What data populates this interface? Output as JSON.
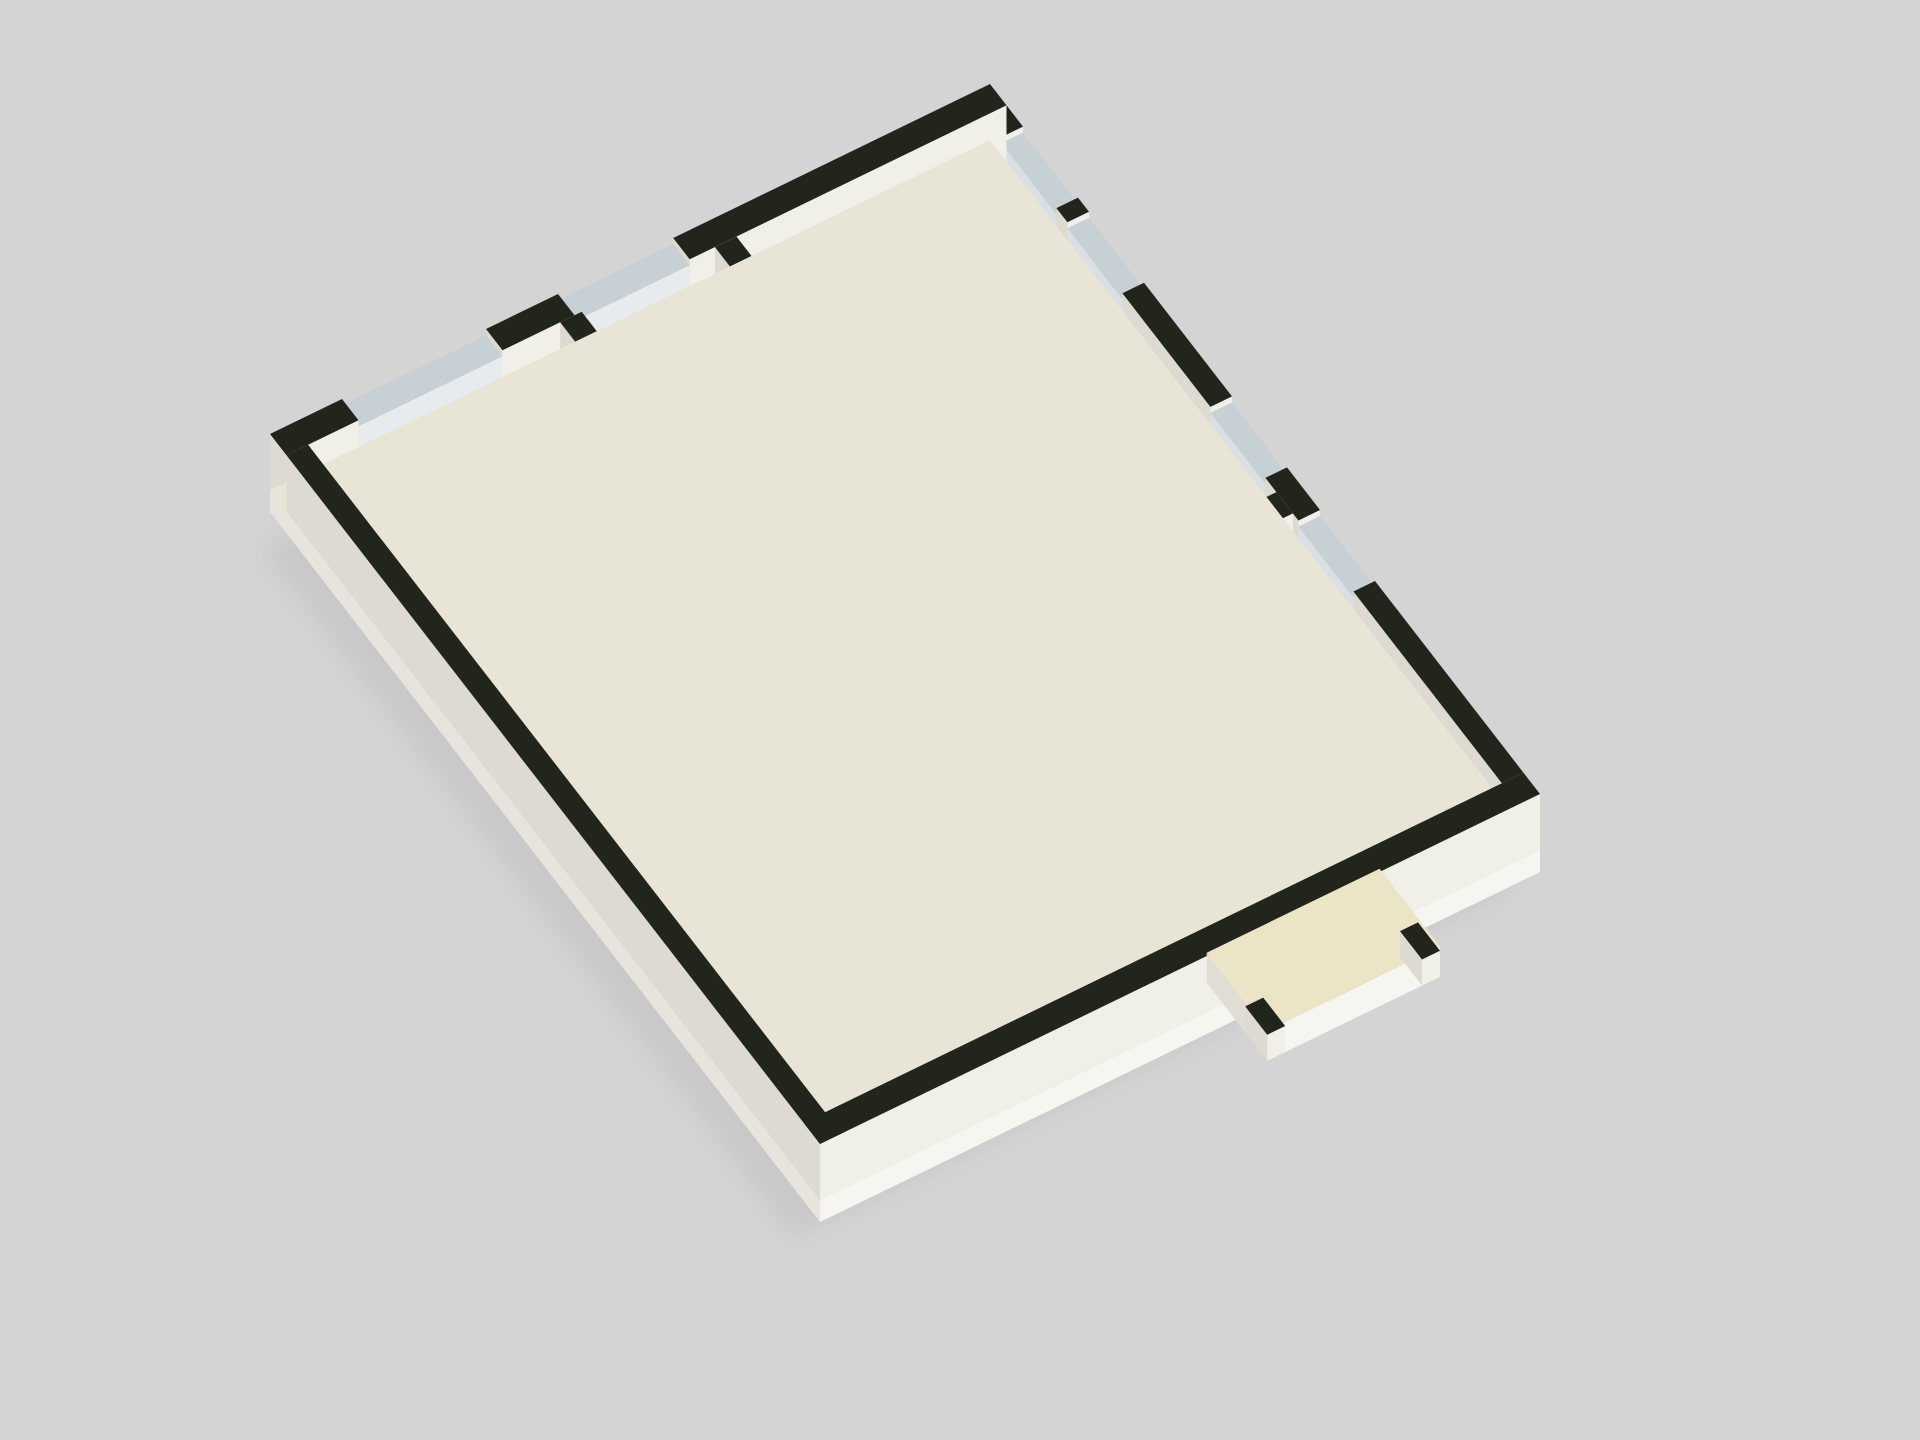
{
  "scene_type": "isometric-3d-floor-plan-render",
  "background": "#d4d4d4",
  "iso": {
    "ox": 270,
    "oy": 490,
    "ax": 7.2,
    "ay": -3.5,
    "bx": 5.5,
    "by": 7.1
  },
  "palette": {
    "colors": {
      "floorBase": "#e9e5d6",
      "floorCream": "#f2ebc3",
      "floorTeal": "#79a39d",
      "grid": "rgba(255,255,255,0.5)",
      "tealGrid": "rgba(255,255,255,0.25)",
      "shadow": "#bfbfbf",
      "artGreen": "#3f8b33"
    },
    "sets": {
      "wall": {
        "t": "#22251b",
        "s": "#f1f0e8",
        "w": "#dddbd1"
      },
      "window": {
        "t": "#c7d0d4",
        "s": "#e7ebed",
        "w": "#d9dfe2"
      },
      "wood": {
        "t": "#e3ab5d",
        "s": "#c38c44",
        "w": "#a37132"
      },
      "door": {
        "t": "#b9873f",
        "s": "#a9762f",
        "w": "#8d5f22"
      },
      "step": {
        "t": "#f0e9cd",
        "s": "#e0d9ba",
        "w": "#cfc8a8"
      },
      "bed": {
        "t": "#f0efe9",
        "s": "#dddcd4",
        "w": "#cbcac2"
      },
      "pillow": {
        "t": "#fbfbf8",
        "s": "#e8e8e2",
        "w": "#dcdcd6"
      },
      "sofa": {
        "t": "#f3f1ea",
        "s": "#e0ded6",
        "w": "#cfcdc5"
      },
      "shelf": {
        "t": "#e0a153",
        "s": "#c98f43",
        "w": "#a5702b"
      },
      "stall": {
        "t": "#e4e7e0",
        "s": "#d5d8cf",
        "w": "#c5c8bf"
      },
      "counter": {
        "t": "#22251b",
        "s": "#f1f0e8",
        "w": "#dddbd1"
      },
      "canopy": {
        "t": "#ebe4c6",
        "s": "#f6f5ef",
        "w": "#e0ded4"
      },
      "pot": {
        "t": "#9a6c3a",
        "s": "#7d5429",
        "w": "#68451f"
      }
    }
  },
  "items": [
    {
      "t": "shadow",
      "n": "drop-shadow",
      "r": [
        0,
        0,
        100,
        100
      ],
      "layer": 0
    },
    {
      "t": "plinth",
      "n": "foundation-plinth",
      "r": [
        0,
        0,
        100,
        100
      ],
      "d": 22,
      "layer": 0
    },
    {
      "t": "flat",
      "n": "slab",
      "r": [
        0,
        0,
        100,
        100
      ],
      "f": "floorBase",
      "layer": 0
    },
    {
      "t": "flat",
      "n": "floor-marble",
      "r": [
        3,
        3,
        97,
        97
      ],
      "f": "floorCream",
      "grid": 10,
      "gc": "grid",
      "layer": 0
    },
    {
      "t": "flat",
      "n": "floor-washroom",
      "r": [
        3,
        72.5,
        50,
        97
      ],
      "f": "floorTeal",
      "grid": 10,
      "gc": "tealGrid",
      "layer": 0
    },
    {
      "t": "flat",
      "n": "floor-washroom-2",
      "r": [
        50,
        82,
        61,
        97
      ],
      "f": "floorTeal",
      "grid": 10,
      "gc": "tealGrid",
      "layer": 0
    },
    {
      "t": "box",
      "n": "wall-nw-a",
      "r": [
        0,
        0,
        10,
        3
      ],
      "h": 56,
      "c": "wall"
    },
    {
      "t": "box",
      "n": "window-nw-1",
      "r": [
        10,
        0,
        30,
        3
      ],
      "h": 50,
      "c": "window"
    },
    {
      "t": "box",
      "n": "wall-nw-b",
      "r": [
        30,
        0,
        40,
        3
      ],
      "h": 56,
      "c": "wall"
    },
    {
      "t": "box",
      "n": "window-nw-2",
      "r": [
        40,
        0,
        56,
        3
      ],
      "h": 50,
      "c": "window"
    },
    {
      "t": "box",
      "n": "wall-nw-c",
      "r": [
        56,
        0,
        100,
        3
      ],
      "h": 56,
      "c": "wall"
    },
    {
      "t": "box",
      "n": "wall-ne-a",
      "r": [
        97,
        3,
        100,
        6
      ],
      "h": 56,
      "c": "wall"
    },
    {
      "t": "box",
      "n": "window-ne-1",
      "r": [
        97,
        6,
        100,
        16
      ],
      "h": 50,
      "c": "window"
    },
    {
      "t": "box",
      "n": "wall-ne-b",
      "r": [
        97,
        16,
        100,
        18
      ],
      "h": 56,
      "c": "wall"
    },
    {
      "t": "box",
      "n": "window-ne-2",
      "r": [
        97,
        18,
        100,
        28
      ],
      "h": 50,
      "c": "window"
    },
    {
      "t": "box",
      "n": "wall-ne-c",
      "r": [
        97,
        28,
        100,
        44
      ],
      "h": 56,
      "c": "wall"
    },
    {
      "t": "box",
      "n": "window-ne-3",
      "r": [
        97,
        44,
        100,
        54
      ],
      "h": 50,
      "c": "window"
    },
    {
      "t": "box",
      "n": "wall-ne-d",
      "r": [
        97,
        54,
        100,
        60
      ],
      "h": 56,
      "c": "wall"
    },
    {
      "t": "box",
      "n": "window-ne-4",
      "r": [
        97,
        60,
        100,
        70
      ],
      "h": 50,
      "c": "window"
    },
    {
      "t": "box",
      "n": "wall-ne-e",
      "r": [
        97,
        70,
        100,
        97
      ],
      "h": 56,
      "c": "wall"
    },
    {
      "t": "box",
      "n": "wall-sw",
      "r": [
        0,
        3,
        3,
        100
      ],
      "h": 56,
      "c": "wall"
    },
    {
      "t": "box",
      "n": "wall-se",
      "r": [
        0,
        97,
        100,
        100
      ],
      "h": 56,
      "c": "wall"
    },
    {
      "t": "box",
      "n": "wall-left-room-a",
      "r": [
        3,
        40,
        22,
        43
      ],
      "h": 56,
      "c": "wall"
    },
    {
      "t": "box",
      "n": "wall-left-room-b",
      "r": [
        30,
        40,
        38,
        43
      ],
      "h": 56,
      "c": "wall"
    },
    {
      "t": "box",
      "n": "wall-bl-a",
      "r": [
        3,
        59.5,
        32,
        62.5
      ],
      "h": 56,
      "c": "wall"
    },
    {
      "t": "box",
      "n": "wall-bl-b",
      "r": [
        38,
        59.5,
        44,
        62.5
      ],
      "h": 56,
      "c": "wall"
    },
    {
      "t": "box",
      "n": "wall-mid-vert-a",
      "r": [
        38,
        3,
        41,
        14
      ],
      "h": 56,
      "c": "wall"
    },
    {
      "t": "box",
      "n": "wall-mid-vert-b",
      "r": [
        38,
        20,
        41,
        40
      ],
      "h": 56,
      "c": "wall"
    },
    {
      "t": "box",
      "n": "wall-mid-vert-c",
      "r": [
        38,
        43,
        41,
        48
      ],
      "h": 56,
      "c": "wall"
    },
    {
      "t": "box",
      "n": "wall-mid-vert-d",
      "r": [
        38,
        54,
        41,
        59.5
      ],
      "h": 56,
      "c": "wall"
    },
    {
      "t": "box",
      "n": "wall-stair-right",
      "r": [
        59.5,
        3,
        62.5,
        31
      ],
      "h": 56,
      "c": "wall"
    },
    {
      "t": "box",
      "n": "wall-stair-bottom-a",
      "r": [
        41,
        31,
        44,
        34
      ],
      "h": 56,
      "c": "wall"
    },
    {
      "t": "box",
      "n": "wall-stair-bottom-b",
      "r": [
        50,
        31,
        62.5,
        34
      ],
      "h": 56,
      "c": "wall"
    },
    {
      "t": "box",
      "n": "stair-divider",
      "r": [
        44,
        19.5,
        57.5,
        21.5
      ],
      "h": 56,
      "c": "wall"
    },
    {
      "t": "box",
      "n": "wall-corridor-a",
      "r": [
        72,
        6,
        75,
        30
      ],
      "h": 56,
      "c": "wall"
    },
    {
      "t": "box",
      "n": "wall-corridor-b",
      "r": [
        72,
        36,
        75,
        56
      ],
      "h": 56,
      "c": "wall"
    },
    {
      "t": "box",
      "n": "wall-corridor-c",
      "r": [
        72,
        62,
        75,
        76
      ],
      "h": 56,
      "c": "wall"
    },
    {
      "t": "box",
      "n": "wall-lounge-a",
      "r": [
        59.5,
        34,
        62.5,
        44
      ],
      "h": 56,
      "c": "wall"
    },
    {
      "t": "box",
      "n": "wall-lounge-b",
      "r": [
        59.5,
        50,
        62.5,
        70
      ],
      "h": 56,
      "c": "wall"
    },
    {
      "t": "box",
      "n": "wall-bed-div-1",
      "r": [
        75,
        30,
        97,
        33
      ],
      "h": 56,
      "c": "wall"
    },
    {
      "t": "box",
      "n": "wall-bed-div-2",
      "r": [
        75,
        56,
        97,
        59
      ],
      "h": 56,
      "c": "wall"
    },
    {
      "t": "box",
      "n": "wall-bed-div-3",
      "r": [
        75,
        80,
        97,
        83
      ],
      "h": 56,
      "c": "wall"
    },
    {
      "t": "box",
      "n": "wall-wash-a",
      "r": [
        3,
        70,
        30,
        72.5
      ],
      "h": 56,
      "c": "wall"
    },
    {
      "t": "box",
      "n": "wall-wash-b",
      "r": [
        36,
        70,
        50,
        72.5
      ],
      "h": 56,
      "c": "wall"
    },
    {
      "t": "box",
      "n": "wall-small-room",
      "r": [
        62.5,
        70,
        72,
        72.5
      ],
      "h": 56,
      "c": "wall"
    },
    {
      "t": "steps",
      "n": "stair1-run-down",
      "axis": "a",
      "b": [
        13.5,
        19.5
      ],
      "a0": 42,
      "w": 1.8,
      "count": 8,
      "h0": 4,
      "dh": 2.6,
      "c": "step"
    },
    {
      "t": "box",
      "n": "stair1-landing",
      "r": [
        56.4,
        8,
        59.5,
        28
      ],
      "h": 24,
      "c": "step"
    },
    {
      "t": "steps",
      "n": "stair1-run-up",
      "axis": "a",
      "b": [
        21.5,
        27.5
      ],
      "a0": 42,
      "w": 1.8,
      "count": 8,
      "h0": 52,
      "dh": -3.7,
      "c": "step"
    },
    {
      "t": "box",
      "n": "stair2-landing",
      "r": [
        63,
        74,
        74,
        78
      ],
      "h": 50,
      "c": "step"
    },
    {
      "t": "steps",
      "n": "stair2-run",
      "axis": "b",
      "a": [
        63,
        74
      ],
      "b0": 78,
      "w": 2.05,
      "count": 9,
      "h0": 46,
      "dh": -5,
      "c": "step"
    },
    {
      "t": "box",
      "n": "stair2-rail-left",
      "r": [
        60.5,
        76,
        63,
        96.5
      ],
      "h": 44,
      "c": "wall"
    },
    {
      "t": "box",
      "n": "stair2-rail-right",
      "r": [
        74,
        76,
        76.5,
        96.5
      ],
      "h": 44,
      "c": "wall"
    },
    {
      "t": "box",
      "n": "porch-canopy",
      "r": [
        56,
        97,
        80,
        108
      ],
      "h": 30,
      "c": "canopy",
      "key": 800
    },
    {
      "t": "box",
      "n": "porch-post-a",
      "r": [
        56,
        104,
        58.5,
        108
      ],
      "h": 26,
      "c": "wall",
      "key": 805
    },
    {
      "t": "box",
      "n": "porch-post-b",
      "r": [
        77.5,
        104,
        80,
        108
      ],
      "h": 26,
      "c": "wall",
      "key": 806
    },
    {
      "t": "shelf",
      "n": "tv-cabinet",
      "r": [
        8,
        3,
        20,
        7.5
      ],
      "h": 16,
      "c": "wood",
      "lines": 1,
      "lc": "#4a3413"
    },
    {
      "t": "box",
      "n": "desk-strip",
      "r": [
        6,
        56,
        28,
        59.5
      ],
      "h": 13,
      "c": "wood"
    },
    {
      "t": "shelf",
      "n": "cabinet-mid",
      "r": [
        28,
        63,
        34,
        70
      ],
      "h": 20,
      "c": "wood",
      "lines": 1,
      "lc": "#4a3413"
    },
    {
      "t": "box",
      "n": "sofa-back",
      "r": [
        50,
        40,
        52.5,
        62
      ],
      "h": 30,
      "c": "sofa"
    },
    {
      "t": "box",
      "n": "sofa-seat",
      "r": [
        45.5,
        40,
        50,
        62
      ],
      "h": 18,
      "c": "sofa"
    },
    {
      "t": "box",
      "n": "sofa-corner-back",
      "r": [
        41,
        62,
        52.5,
        64.5
      ],
      "h": 30,
      "c": "sofa"
    },
    {
      "t": "box",
      "n": "sofa-seat-end",
      "r": [
        41,
        57,
        45.5,
        62
      ],
      "h": 18,
      "c": "sofa"
    },
    {
      "t": "box",
      "n": "coffee-table",
      "r": [
        40.5,
        46,
        45,
        54
      ],
      "h": 13,
      "c": "wood"
    },
    {
      "t": "shelf",
      "n": "bookshelf",
      "r": [
        80,
        33.3,
        96,
        36.6
      ],
      "h": 48,
      "c": "shelf",
      "lines": 3,
      "lc": "#6f4b17"
    },
    {
      "t": "box",
      "n": "bed",
      "r": [
        79,
        5,
        95,
        11
      ],
      "h": 18,
      "c": "bed"
    },
    {
      "t": "box",
      "n": "pillow",
      "r": [
        91.5,
        6,
        94.5,
        10
      ],
      "h": 21,
      "c": "pillow"
    },
    {
      "t": "box",
      "n": "bed",
      "r": [
        79,
        14,
        95,
        20
      ],
      "h": 18,
      "c": "bed"
    },
    {
      "t": "box",
      "n": "pillow",
      "r": [
        91.5,
        15,
        94.5,
        19
      ],
      "h": 21,
      "c": "pillow"
    },
    {
      "t": "box",
      "n": "bed",
      "r": [
        79,
        22.5,
        95,
        28.5
      ],
      "h": 18,
      "c": "bed"
    },
    {
      "t": "box",
      "n": "pillow",
      "r": [
        91.5,
        23.5,
        94.5,
        27.5
      ],
      "h": 21,
      "c": "pillow"
    },
    {
      "t": "box",
      "n": "nightstand",
      "r": [
        93.5,
        11.6,
        96.8,
        13.9
      ],
      "h": 15,
      "c": "wood"
    },
    {
      "t": "box",
      "n": "nightstand",
      "r": [
        93.5,
        20.4,
        96.8,
        22.7
      ],
      "h": 15,
      "c": "wood"
    },
    {
      "t": "box",
      "n": "bed",
      "r": [
        79,
        37,
        95,
        43
      ],
      "h": 18,
      "c": "bed"
    },
    {
      "t": "box",
      "n": "pillow",
      "r": [
        91.5,
        38,
        94.5,
        42
      ],
      "h": 21,
      "c": "pillow"
    },
    {
      "t": "box",
      "n": "bed",
      "r": [
        79,
        46,
        95,
        52
      ],
      "h": 18,
      "c": "bed"
    },
    {
      "t": "box",
      "n": "pillow",
      "r": [
        91.5,
        47,
        94.5,
        51
      ],
      "h": 21,
      "c": "pillow"
    },
    {
      "t": "box",
      "n": "bed",
      "r": [
        79,
        61,
        95,
        67
      ],
      "h": 18,
      "c": "bed"
    },
    {
      "t": "box",
      "n": "pillow",
      "r": [
        91.5,
        62,
        94.5,
        66
      ],
      "h": 21,
      "c": "pillow"
    },
    {
      "t": "box",
      "n": "side-cabinet",
      "r": [
        90.5,
        68.5,
        95,
        72.5
      ],
      "h": 16,
      "c": "wood"
    },
    {
      "t": "box",
      "n": "bed",
      "r": [
        79,
        73,
        95,
        78.5
      ],
      "h": 18,
      "c": "bed"
    },
    {
      "t": "box",
      "n": "pillow",
      "r": [
        91.5,
        74,
        94.5,
        77.8
      ],
      "h": 21,
      "c": "pillow"
    },
    {
      "t": "box",
      "n": "bed",
      "r": [
        79,
        86,
        95,
        92
      ],
      "h": 18,
      "c": "bed"
    },
    {
      "t": "box",
      "n": "pillow",
      "r": [
        91.5,
        87,
        94.5,
        91
      ],
      "h": 21,
      "c": "pillow"
    },
    {
      "t": "box",
      "n": "bed-small",
      "r": [
        64,
        63,
        75.5,
        68
      ],
      "h": 18,
      "c": "bed"
    },
    {
      "t": "box",
      "n": "pillow",
      "r": [
        64.5,
        63.8,
        67.5,
        67.4
      ],
      "h": 21,
      "c": "pillow"
    },
    {
      "t": "box",
      "n": "door",
      "r": [
        22,
        43,
        23.2,
        50.5
      ],
      "h": 52,
      "c": "door"
    },
    {
      "t": "box",
      "n": "door",
      "r": [
        32,
        62.5,
        33.2,
        70
      ],
      "h": 52,
      "c": "door"
    },
    {
      "t": "box",
      "n": "door",
      "r": [
        38,
        14,
        39.2,
        20
      ],
      "h": 52,
      "c": "door"
    },
    {
      "t": "box",
      "n": "door",
      "r": [
        72,
        30,
        73.2,
        37
      ],
      "h": 52,
      "c": "door"
    },
    {
      "t": "box",
      "n": "door",
      "r": [
        72,
        56,
        73.2,
        63
      ],
      "h": 52,
      "c": "door"
    },
    {
      "t": "box",
      "n": "door",
      "r": [
        59.5,
        44,
        60.7,
        50.5
      ],
      "h": 52,
      "c": "door"
    },
    {
      "t": "box",
      "n": "door",
      "r": [
        44,
        31,
        45.2,
        37.5
      ],
      "h": 52,
      "c": "door"
    },
    {
      "t": "box",
      "n": "door",
      "r": [
        30.5,
        70,
        31.7,
        77
      ],
      "h": 52,
      "c": "door"
    },
    {
      "t": "box",
      "n": "stall-partition",
      "r": [
        5,
        74,
        6.2,
        86
      ],
      "h": 34,
      "c": "stall"
    },
    {
      "t": "box",
      "n": "stall-partition",
      "r": [
        11,
        74,
        12.2,
        86
      ],
      "h": 34,
      "c": "stall"
    },
    {
      "t": "box",
      "n": "stall-partition",
      "r": [
        17,
        74,
        18.2,
        86
      ],
      "h": 34,
      "c": "stall"
    },
    {
      "t": "toilet",
      "n": "toilet",
      "a": 8.6,
      "b": 81
    },
    {
      "t": "toilet",
      "n": "toilet",
      "a": 14.6,
      "b": 81
    },
    {
      "t": "box",
      "n": "sink-counter",
      "r": [
        20,
        90,
        36,
        94.5
      ],
      "h": 20,
      "c": "counter"
    },
    {
      "t": "box",
      "n": "sink-counter-2",
      "r": [
        44,
        89,
        50,
        95
      ],
      "h": 20,
      "c": "counter"
    },
    {
      "t": "art",
      "n": "wall-art",
      "a": 59.5,
      "b": [
        36,
        41.5
      ],
      "z": [
        22,
        36
      ],
      "f": "artGreen"
    },
    {
      "t": "art",
      "n": "wall-art",
      "a": 59.5,
      "b": [
        8,
        13.5
      ],
      "z": [
        22,
        36
      ],
      "f": "artGreen"
    },
    {
      "t": "plant",
      "n": "potted-plant",
      "a": 61,
      "b": 72.8
    }
  ]
}
